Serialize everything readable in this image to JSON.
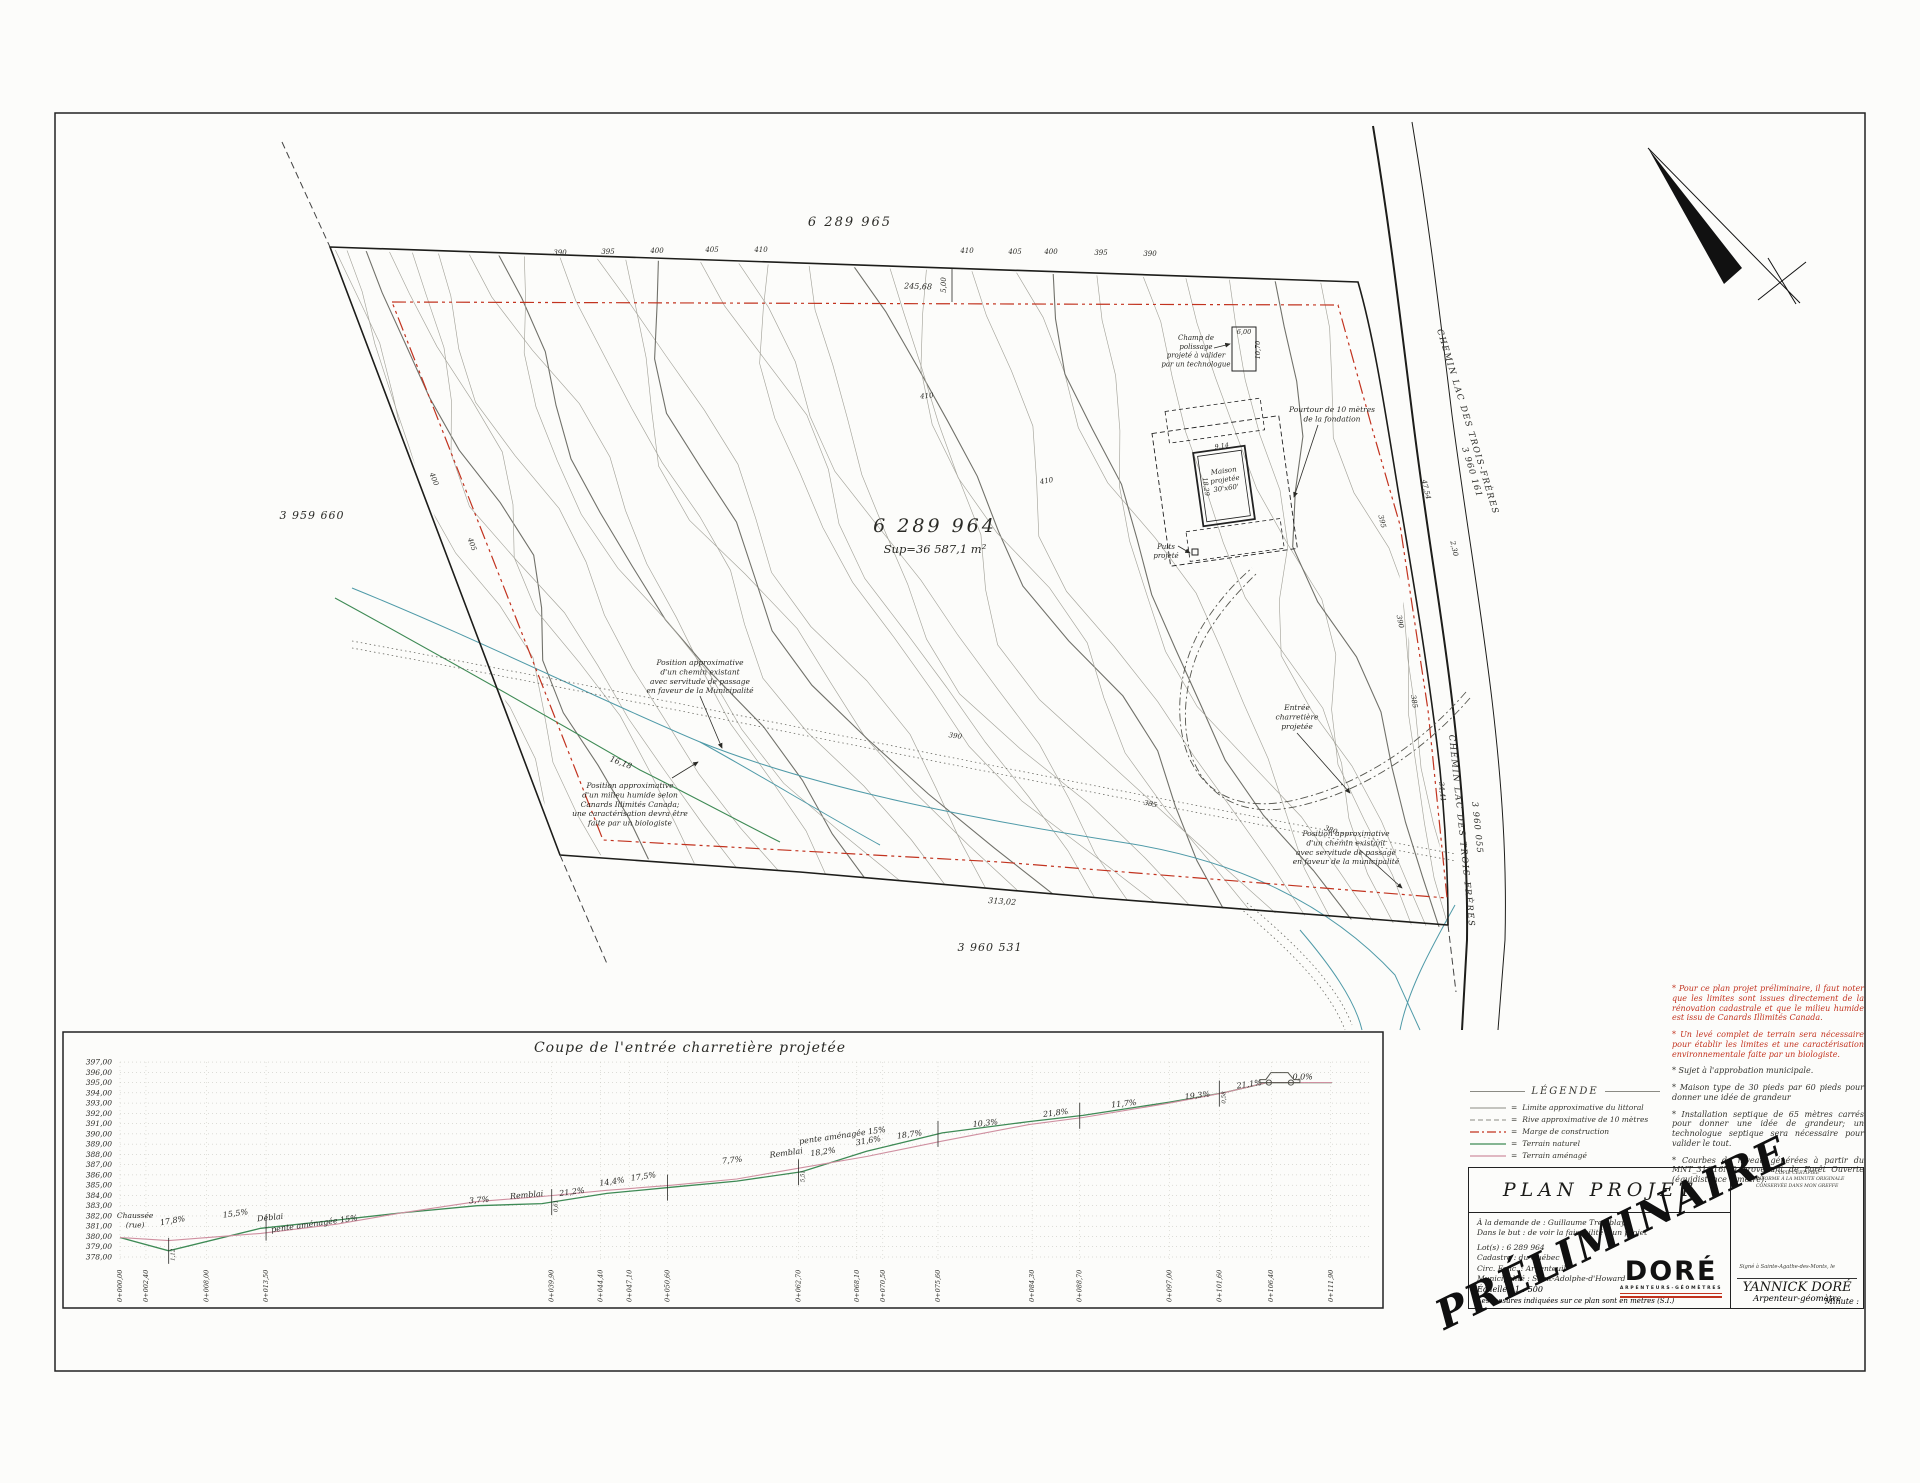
{
  "colors": {
    "red": "#c2331f",
    "teal": "#4f9aa8",
    "green": "#3e8a55",
    "pink": "#cf8fa0",
    "gray": "#8b8b84"
  },
  "map": {
    "labels": [
      {
        "t": "6 289 965",
        "x": 850,
        "y": 226,
        "s": 13,
        "ls": 2,
        "name": "lot-label-6289965"
      },
      {
        "t": "6 289 964",
        "x": 935,
        "y": 532,
        "s": 19,
        "ls": 3,
        "name": "lot-label-6289964"
      },
      {
        "t": "Sup=36 587,1 m²",
        "x": 935,
        "y": 553,
        "s": 11.5,
        "name": "lot-area-label"
      },
      {
        "t": "3 959 660",
        "x": 312,
        "y": 519,
        "s": 11,
        "ls": 1,
        "name": "lot-label-3959660"
      },
      {
        "t": "3 960 531",
        "x": 990,
        "y": 951,
        "s": 11,
        "ls": 1,
        "name": "lot-label-3960531"
      },
      {
        "t": "CHEMIN LAC DES TROIS-FRÈRES",
        "x": 1437,
        "y": 330,
        "s": 8.5,
        "r": 73,
        "ls": 1.5,
        "a": "s",
        "name": "road-name-upper"
      },
      {
        "t": "3 960 161",
        "x": 1462,
        "y": 448,
        "s": 8.5,
        "r": 73,
        "ls": 1,
        "a": "s",
        "name": "road-lot-3960161"
      },
      {
        "t": "CHEMIN LAC DES TROIS-FRÈRES",
        "x": 1449,
        "y": 735,
        "s": 8.5,
        "r": 84,
        "ls": 1.5,
        "a": "s",
        "name": "road-name-lower"
      },
      {
        "t": "3 960 055",
        "x": 1472,
        "y": 802,
        "s": 8.5,
        "r": 84,
        "ls": 1,
        "a": "s",
        "name": "road-lot-3960055"
      },
      {
        "t": "Position approximative|d'un chemin existant|avec servitude de passage|en faveur de la Municipalité",
        "x": 700,
        "y": 665,
        "s": 7.5,
        "name": "note-existing-road"
      },
      {
        "t": "Position approximative|d'un milieu humide selon|Canards Illimités Canada;|une caractérisation devra être|faite par un biologiste",
        "x": 630,
        "y": 788,
        "s": 7.5,
        "name": "note-wetland"
      },
      {
        "t": "Entrée|charretière|projetée",
        "x": 1297,
        "y": 710,
        "s": 7.5,
        "name": "note-driveway"
      },
      {
        "t": "Pourtour de 10 mètres|de la fondation",
        "x": 1332,
        "y": 412,
        "s": 7.5,
        "name": "note-foundation-buffer"
      },
      {
        "t": "Champ de|polissage|projeté à valider|par un technologue",
        "x": 1196,
        "y": 340,
        "s": 7,
        "name": "note-polishing-field"
      },
      {
        "t": "Puits|projeté",
        "x": 1166,
        "y": 549,
        "s": 7,
        "name": "note-well"
      },
      {
        "t": "Maison|projetée|30'x60'",
        "x": 1224,
        "y": 473,
        "s": 7,
        "r": -8,
        "name": "label-projected-house"
      },
      {
        "t": "Position approximative|d'un chemin existant|avec servitude de passage|en faveur de la municipalité",
        "x": 1346,
        "y": 836,
        "s": 7.5,
        "name": "note-existing-road-south"
      }
    ],
    "dimensions": [
      {
        "t": "245,68",
        "x": 918,
        "y": 289,
        "s": 8,
        "r": 2
      },
      {
        "t": "5,00",
        "x": 946,
        "y": 285,
        "s": 7,
        "r": -90
      },
      {
        "t": "313,02",
        "x": 1002,
        "y": 904,
        "s": 8,
        "r": 4
      },
      {
        "t": "16,18",
        "x": 620,
        "y": 765,
        "s": 8,
        "r": 21
      },
      {
        "t": "2,30",
        "x": 1452,
        "y": 549,
        "s": 7,
        "r": 78
      },
      {
        "t": "47,54",
        "x": 1424,
        "y": 490,
        "s": 7,
        "r": 76
      },
      {
        "t": "34,41",
        "x": 1440,
        "y": 792,
        "s": 7,
        "r": 84
      },
      {
        "t": "6,00",
        "x": 1244,
        "y": 334,
        "s": 6.5
      },
      {
        "t": "10,70",
        "x": 1260,
        "y": 350,
        "s": 6.5,
        "r": -90
      },
      {
        "t": "9,14",
        "x": 1222,
        "y": 448,
        "s": 6.5,
        "r": -8
      },
      {
        "t": "18,29",
        "x": 1204,
        "y": 487,
        "s": 6.5,
        "r": 82
      }
    ],
    "contour_labels": [
      {
        "t": "390",
        "x": 560,
        "y": 255
      },
      {
        "t": "395",
        "x": 608,
        "y": 254
      },
      {
        "t": "400",
        "x": 657,
        "y": 253
      },
      {
        "t": "405",
        "x": 712,
        "y": 252
      },
      {
        "t": "410",
        "x": 761,
        "y": 252
      },
      {
        "t": "410",
        "x": 967,
        "y": 253
      },
      {
        "t": "405",
        "x": 1015,
        "y": 254
      },
      {
        "t": "400",
        "x": 1051,
        "y": 254
      },
      {
        "t": "395",
        "x": 1101,
        "y": 255
      },
      {
        "t": "390",
        "x": 1150,
        "y": 256
      },
      {
        "t": "410",
        "x": 927,
        "y": 398,
        "r": -5
      },
      {
        "t": "410",
        "x": 1047,
        "y": 483,
        "r": -10
      },
      {
        "t": "400",
        "x": 432,
        "y": 480,
        "r": 68
      },
      {
        "t": "405",
        "x": 470,
        "y": 545,
        "r": 70
      },
      {
        "t": "390",
        "x": 955,
        "y": 738,
        "r": 8
      },
      {
        "t": "385",
        "x": 1150,
        "y": 806,
        "r": 12
      },
      {
        "t": "395",
        "x": 1380,
        "y": 522,
        "r": 76
      },
      {
        "t": "390",
        "x": 1398,
        "y": 622,
        "r": 78
      },
      {
        "t": "385",
        "x": 1412,
        "y": 702,
        "r": 80
      },
      {
        "t": "380",
        "x": 1330,
        "y": 832,
        "r": 20
      }
    ]
  },
  "legend": {
    "title": "LÉGENDE",
    "items": [
      {
        "label": "Limite approximative du littoral",
        "color": "#8b8b84",
        "dash": "",
        "w": 0.9
      },
      {
        "label": "Rive approximative de 10 mètres",
        "color": "#8b8b84",
        "dash": "5,3",
        "w": 0.9
      },
      {
        "label": "Marge de construction",
        "color": "#c2331f",
        "dash": "9,3,2,3",
        "w": 1.3
      },
      {
        "label": "Terrain naturel",
        "color": "#3e8a55",
        "dash": "",
        "w": 1.3
      },
      {
        "label": "Terrain aménagé",
        "color": "#cf8fa0",
        "dash": "",
        "w": 1.3
      }
    ]
  },
  "notes": [
    {
      "red": true,
      "text": "* Pour ce plan projet préliminaire, il faut noter que les limites sont issues directement de la rénovation cadastrale et que le milieu humide est issu de Canards Illimités Canada."
    },
    {
      "red": true,
      "text": "* Un levé complet de terrain sera nécessaire pour établir les limites et une caractérisation environnementale faite par un biologiste."
    },
    {
      "red": false,
      "text": "* Sujet à l'approbation municipale."
    },
    {
      "red": false,
      "text": "* Maison type de 30 pieds par 60 pieds pour donner une idée de grandeur"
    },
    {
      "red": false,
      "text": "* Installation septique de 65 mètres carrés pour donner une idée de grandeur; un technologue septique sera nécessaire pour valider le tout."
    },
    {
      "red": false,
      "text": "* Courbes de niveau générées à partir du MNT_31G16NO provenant de Forêt Ouverte (équidistance 1 mètre)."
    }
  ],
  "title_block": {
    "title": "PLAN PROJET",
    "info_lines": [
      "À la demande de : Guillaume Tremblay",
      "Dans le but : de voir la faisabilité d'un projet",
      "Lot(s) : 6 289 964",
      "Cadastre : du Québec",
      "Circ. Fonc. : Argenteuil",
      "Municipalité : Saint-Adolphe-d'Howard"
    ],
    "scale": "Échelle : 1 : 500",
    "units": "Les mesures indiquées sur ce plan sont en mètres (S.I.)",
    "logo": "DORÉ",
    "logo_sub": "ARPENTEURS-GÉOMÈTRES",
    "cert_lines": [
      "COPIE CERTIFIÉE",
      "CONFORME À LA MINUTE ORIGINALE",
      "CONSERVÉE DANS MON GREFFE"
    ],
    "signed": "Signé à Sainte-Agathe-des-Monts, le",
    "surveyor": "YANNICK DORÉ",
    "role": "Arpenteur-géomètre",
    "minute": "Minute :",
    "stamp": "PRÉLIMINAIRE"
  },
  "chart_data": {
    "type": "line",
    "title": "Coupe de l'entrée charretière projetée",
    "ylim": [
      378,
      397
    ],
    "y_tick_step": 1,
    "grid": true,
    "start_label": "Chaussée|(rue)",
    "x": [
      0,
      4.5,
      13,
      20,
      26,
      33,
      39,
      45,
      51,
      57,
      63,
      69,
      76,
      84,
      89,
      97,
      102,
      106,
      112
    ],
    "series": [
      {
        "name": "Terrain naturel",
        "color": "#3e8a55",
        "values": [
          379.9,
          378.6,
          380.8,
          381.6,
          382.3,
          383.0,
          383.2,
          384.2,
          384.8,
          385.4,
          386.3,
          388.3,
          390.1,
          391.2,
          391.8,
          393.1,
          394.0,
          395.0,
          395.0
        ]
      },
      {
        "name": "Terrain aménagé",
        "color": "#cf8fa0",
        "values": [
          379.9,
          379.6,
          380.3,
          381.2,
          382.3,
          383.4,
          383.9,
          384.5,
          385.0,
          385.6,
          386.7,
          387.8,
          389.3,
          390.9,
          391.6,
          393.0,
          394.0,
          395.0,
          395.0
        ]
      }
    ],
    "stations": [
      {
        "m": 0.0,
        "label": "0+000,00"
      },
      {
        "m": 2.4,
        "label": "0+002,40"
      },
      {
        "m": 8.0,
        "label": "0+008,00"
      },
      {
        "m": 13.5,
        "label": "0+013,50"
      },
      {
        "m": 39.9,
        "label": "0+039,90"
      },
      {
        "m": 44.4,
        "label": "0+044,40"
      },
      {
        "m": 47.1,
        "label": "0+047,10"
      },
      {
        "m": 50.6,
        "label": "0+050,60"
      },
      {
        "m": 62.7,
        "label": "0+062,70"
      },
      {
        "m": 68.1,
        "label": "0+068,10"
      },
      {
        "m": 70.5,
        "label": "0+070,50"
      },
      {
        "m": 75.6,
        "label": "0+075,60"
      },
      {
        "m": 84.3,
        "label": "0+084,30"
      },
      {
        "m": 88.7,
        "label": "0+088,70"
      },
      {
        "m": 97.0,
        "label": "0+097,00"
      },
      {
        "m": 101.6,
        "label": "0+101,60"
      },
      {
        "m": 106.4,
        "label": "0+106,40"
      },
      {
        "m": 111.9,
        "label": "0+111,90"
      }
    ],
    "slope_labels": [
      {
        "t": "17,8%",
        "m": 4.9,
        "e": 381.3,
        "r": -10
      },
      {
        "t": "15,5%",
        "m": 10.7,
        "e": 382.0,
        "r": -8
      },
      {
        "t": "Déblai",
        "m": 13.9,
        "e": 381.6,
        "r": -6
      },
      {
        "t": "pente aménagée 15%",
        "m": 18.0,
        "e": 381.0,
        "r": -8
      },
      {
        "t": "3,7%",
        "m": 33.2,
        "e": 383.3,
        "r": -4
      },
      {
        "t": "Remblai",
        "m": 37.6,
        "e": 383.8,
        "r": -5
      },
      {
        "t": "21,2%",
        "m": 41.8,
        "e": 384.1,
        "r": -8
      },
      {
        "t": "14,4%",
        "m": 45.5,
        "e": 385.1,
        "r": -8
      },
      {
        "t": "17,5%",
        "m": 48.4,
        "e": 385.6,
        "r": -8
      },
      {
        "t": "7,7%",
        "m": 56.6,
        "e": 387.2,
        "r": -6
      },
      {
        "t": "Remblai",
        "m": 61.6,
        "e": 387.9,
        "r": -8
      },
      {
        "t": "18,2%",
        "m": 65.0,
        "e": 388.0,
        "r": -8
      },
      {
        "t": "pente aménagée 15%",
        "m": 66.8,
        "e": 389.6,
        "r": -8
      },
      {
        "t": "31,6%",
        "m": 69.2,
        "e": 389.1,
        "r": -10
      },
      {
        "t": "18,7%",
        "m": 73.0,
        "e": 389.7,
        "r": -8
      },
      {
        "t": "10,3%",
        "m": 80.0,
        "e": 390.8,
        "r": -6
      },
      {
        "t": "21,8%",
        "m": 86.5,
        "e": 391.8,
        "r": -7
      },
      {
        "t": "11,7%",
        "m": 92.8,
        "e": 392.7,
        "r": -6
      },
      {
        "t": "19,3%",
        "m": 99.6,
        "e": 393.5,
        "r": -7
      },
      {
        "t": "21,1%",
        "m": 104.4,
        "e": 394.6,
        "r": -8
      },
      {
        "t": "0,0%",
        "m": 109.3,
        "e": 395.3,
        "r": 0
      }
    ],
    "break_bars": [
      {
        "m": 4.5,
        "t": "1,12"
      },
      {
        "m": 13.5
      },
      {
        "m": 39.9,
        "t": "0,61"
      },
      {
        "m": 50.6
      },
      {
        "m": 62.7,
        "t": "5,51"
      },
      {
        "m": 75.6
      },
      {
        "m": 88.7
      },
      {
        "m": 101.6,
        "t": "0,58"
      }
    ]
  }
}
